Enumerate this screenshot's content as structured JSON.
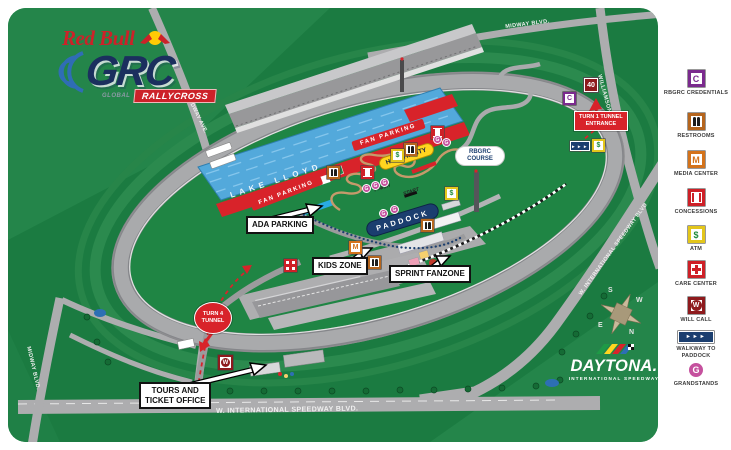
{
  "branding": {
    "red_bull": "Red Bull",
    "grc": "GRC",
    "global": "GLOBAL",
    "rallycross": "RALLYCROSS"
  },
  "daytona": {
    "name": "DAYTONA.",
    "subtitle": "INTERNATIONAL SPEEDWAY"
  },
  "legend": {
    "items": [
      {
        "label": "RBGRC CREDENTIALS",
        "glyph": "C",
        "icon": "credentials-icon"
      },
      {
        "label": "RESTROOMS",
        "glyph": "",
        "icon": "restrooms-icon"
      },
      {
        "label": "MEDIA CENTER",
        "glyph": "M",
        "icon": "media-center-icon"
      },
      {
        "label": "CONCESSIONS",
        "glyph": "",
        "icon": "concessions-icon"
      },
      {
        "label": "ATM",
        "glyph": "$",
        "icon": "atm-icon"
      },
      {
        "label": "CARE CENTER",
        "glyph": "",
        "icon": "care-center-icon"
      },
      {
        "label": "WILL CALL",
        "glyph": "W",
        "icon": "will-call-icon"
      },
      {
        "label": "WALKWAY TO PADDOCK",
        "glyph": "►►►",
        "icon": "walkway-icon"
      },
      {
        "label": "GRANDSTANDS",
        "glyph": "G",
        "icon": "grandstands-icon"
      }
    ]
  },
  "map": {
    "lake": "LAKE LLOYD",
    "fan_parking": "FAN PARKING",
    "hospitality": "HOSPITALITY",
    "course_line1": "RBGRC",
    "course_line2": "COURSE",
    "paddock": "PADDOCK",
    "finish": "FINISH",
    "start": "START",
    "ada_parking": "ADA PARKING",
    "kids_zone": "KIDS ZONE",
    "sprint_fanzone": "SPRINT FANZONE",
    "tours_line1": "TOURS AND",
    "tours_line2": "TICKET OFFICE",
    "turn4_line1": "TURN 4",
    "turn4_line2": "TUNNEL",
    "turn1_line1": "TURN 1 TUNNEL",
    "turn1_line2": "ENTRANCE",
    "route_shield": "40"
  },
  "roads": {
    "midway_ave": "MIDWAY AVE.",
    "midway_blvd_top": "MIDWAY BLVD.",
    "midway_blvd_left": "MIDWAY BLVD.",
    "williamson_blvd": "WILLIAMSON BLVD",
    "intl_speedway_right": "W. INTERNATIONAL SPEEDWAY BLVD",
    "intl_speedway_bottom": "W. INTERNATIONAL SPEEDWAY BLVD."
  },
  "compass": {
    "n": "N",
    "s": "S",
    "e": "E",
    "w": "W"
  },
  "colors": {
    "map_green": "#1B7B41",
    "infield_green": "#1F8544",
    "track_gray": "#A9AAAC",
    "lake_blue": "#53A9DB",
    "red": "#D8232A",
    "navy": "#1B3E6F",
    "ada_blue": "#29ABE2",
    "magenta_grandstand": "#C5519E",
    "purple_credentials": "#7B2A8E",
    "orange_media": "#D4731B",
    "yellow_hospitality": "#FFD520"
  }
}
